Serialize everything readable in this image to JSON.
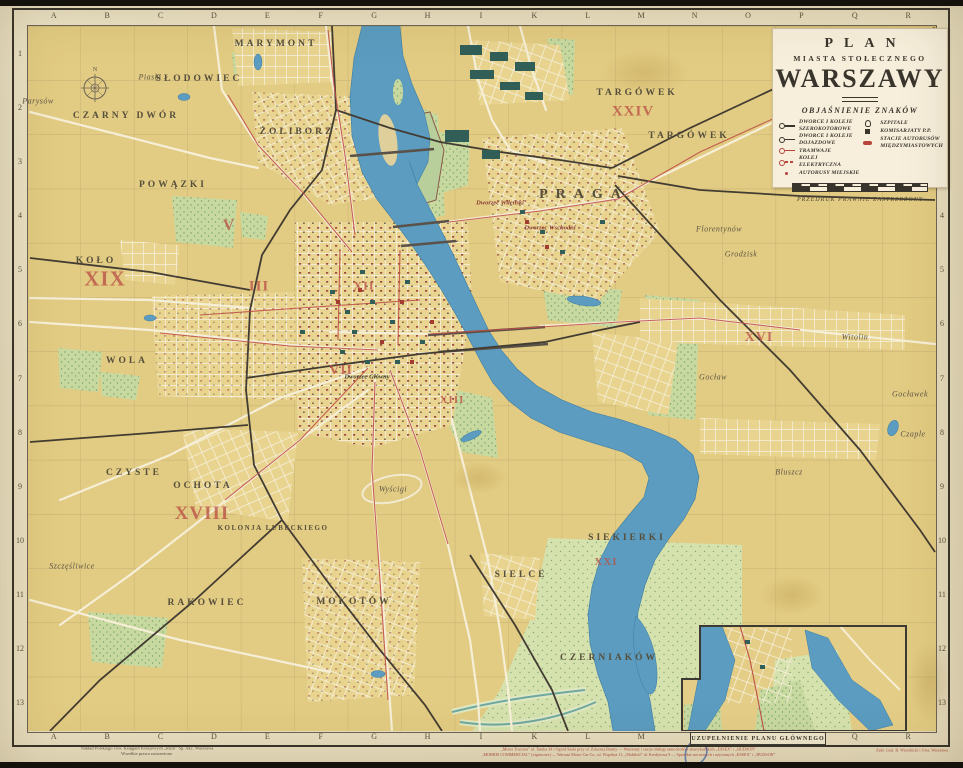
{
  "colors": {
    "paper": "#ece3c6",
    "land": "#e2cb82",
    "water": "#5b9cc0",
    "park": "#c8d9a0",
    "road": "#f6efd7",
    "rail": "#433c32",
    "tram": "#bf5048",
    "accent_red": "#bb5147",
    "frame": "#37322a",
    "cartouche_bg": "#f7efdc"
  },
  "cartouche": {
    "title1": "PLAN",
    "title2": "MIASTA STOŁECZNEGO",
    "title3": "WARSZAWY",
    "legend_title": "OBJAŚNIENIE ZNAKÓW",
    "legend_left": [
      {
        "sym": "rail-broad",
        "label": "DWORCE I KOLEJE SZEROKOTOROWE"
      },
      {
        "sym": "rail-local",
        "label": "DWORCE I KOLEJE DOJAZDOWE"
      },
      {
        "sym": "tram",
        "label": "TRAMWAJE"
      },
      {
        "sym": "elec",
        "label": "KOLEJ ELEKTRYCZNA"
      },
      {
        "sym": "bus",
        "label": "AUTOBUSY MIEJSKIE"
      }
    ],
    "legend_right": [
      {
        "sym": "hospital",
        "label": "SZPITALE"
      },
      {
        "sym": "police",
        "label": "KOMISARJATY P.P."
      },
      {
        "sym": "busstation",
        "label": "STACJE AUTOBUSÓW MIĘDZYMIASTOWYCH"
      }
    ],
    "scale_note": "PRZEDRUK PRAWNIE ZASTRZEŻONY"
  },
  "grid": {
    "cols": [
      "A",
      "B",
      "C",
      "D",
      "E",
      "F",
      "G",
      "H",
      "I",
      "K",
      "L",
      "M",
      "N",
      "O",
      "P",
      "Q",
      "R"
    ],
    "rows": [
      "1",
      "2",
      "3",
      "4",
      "5",
      "6",
      "7",
      "8",
      "9",
      "10",
      "11",
      "12",
      "13"
    ]
  },
  "map": {
    "compass": "N",
    "inset_caption": "UZUPEŁNIENIE PLANU GŁÓWNEGO",
    "labels": [
      {
        "text": "MARYMONT",
        "cls": "lbl district",
        "style": "left:276px;top:44px"
      },
      {
        "text": "Piaski",
        "cls": "lbl hamlet",
        "style": "left:150px;top:77px"
      },
      {
        "text": "Parysów",
        "cls": "lbl hamlet",
        "style": "left:38px;top:101px"
      },
      {
        "text": "SŁODOWIEC",
        "cls": "lbl district",
        "style": "left:199px;top:79px"
      },
      {
        "text": "CZARNY DWÓR",
        "cls": "lbl district",
        "style": "left:126px;top:116px"
      },
      {
        "text": "ŻOLIBORZ",
        "cls": "lbl district",
        "style": "left:297px;top:132px"
      },
      {
        "text": "POWĄZKI",
        "cls": "lbl district",
        "style": "left:173px;top:185px"
      },
      {
        "text": "KOŁO",
        "cls": "lbl district",
        "style": "left:96px;top:261px"
      },
      {
        "text": "WOLA",
        "cls": "lbl district",
        "style": "left:127px;top:361px"
      },
      {
        "text": "CZYSTE",
        "cls": "lbl district",
        "style": "left:134px;top:473px"
      },
      {
        "text": "OCHOTA",
        "cls": "lbl district",
        "style": "left:203px;top:486px"
      },
      {
        "text": "KOLONJA LUBECKIEGO",
        "cls": "lbl district district-sm",
        "style": "left:273px;top:528px"
      },
      {
        "text": "Szczęśliwice",
        "cls": "lbl hamlet",
        "style": "left:72px;top:566px"
      },
      {
        "text": "RAKOWIEC",
        "cls": "lbl district",
        "style": "left:207px;top:603px"
      },
      {
        "text": "MOKOTÓW",
        "cls": "lbl district",
        "style": "left:354px;top:602px"
      },
      {
        "text": "SIELCE",
        "cls": "lbl district",
        "style": "left:521px;top:575px"
      },
      {
        "text": "SIEKIERKI",
        "cls": "lbl district",
        "style": "left:627px;top:538px"
      },
      {
        "text": "CZERNIAKÓW",
        "cls": "lbl district",
        "style": "left:609px;top:658px"
      },
      {
        "text": "PRAGA",
        "cls": "lbl district district-lg",
        "style": "left:584px;top:195px"
      },
      {
        "text": "TARGÓWEK",
        "cls": "lbl district",
        "style": "left:637px;top:93px"
      },
      {
        "text": "TARGÓWEK",
        "cls": "lbl district",
        "style": "left:689px;top:136px"
      },
      {
        "text": "Florentynów",
        "cls": "lbl hamlet",
        "style": "left:719px;top:229px"
      },
      {
        "text": "Grodzisk",
        "cls": "lbl hamlet",
        "style": "left:741px;top:254px"
      },
      {
        "text": "Witolin",
        "cls": "lbl hamlet",
        "style": "left:855px;top:337px"
      },
      {
        "text": "Gocław",
        "cls": "lbl hamlet",
        "style": "left:713px;top:377px"
      },
      {
        "text": "Gocławek",
        "cls": "lbl hamlet",
        "style": "left:910px;top:394px"
      },
      {
        "text": "Czaple",
        "cls": "lbl hamlet",
        "style": "left:913px;top:434px"
      },
      {
        "text": "Bluszcz",
        "cls": "lbl hamlet",
        "style": "left:789px;top:472px"
      },
      {
        "text": "Wyścigi",
        "cls": "lbl hamlet",
        "style": "left:393px;top:489px"
      },
      {
        "text": "Dworzec Główny",
        "cls": "lbl station-dk",
        "style": "left:367px;top:377px"
      },
      {
        "text": "Dworzec Wileński",
        "cls": "lbl station",
        "style": "left:500px;top:203px"
      },
      {
        "text": "Dworzec Wschodni",
        "cls": "lbl station",
        "style": "left:550px;top:228px"
      }
    ],
    "numerals": [
      {
        "text": "XIX",
        "style": "left:105px;top:279px;font-size:21px"
      },
      {
        "text": "XVIII",
        "style": "left:202px;top:514px;font-size:19px"
      },
      {
        "text": "XXIV",
        "style": "left:633px;top:112px;font-size:15px"
      },
      {
        "text": "XXI",
        "style": "left:606px;top:562px;font-size:11px"
      },
      {
        "text": "V",
        "style": "left:229px;top:226px;font-size:16px"
      },
      {
        "text": "III",
        "style": "left:259px;top:287px;font-size:15px"
      },
      {
        "text": "VII",
        "style": "left:341px;top:371px;font-size:14px"
      },
      {
        "text": "XII",
        "style": "left:364px;top:286px;font-size:12px"
      },
      {
        "text": "XIII",
        "style": "left:452px;top:400px;font-size:11px"
      },
      {
        "text": "XVI",
        "style": "left:759px;top:338px;font-size:14px"
      }
    ]
  },
  "imprint": {
    "left1": "Nakład Polskiego Tow. Księgarń Kolejowych „Ruch” Sp. Akc. Warszawa",
    "left2": "Wszelkie prawa zastrzeżone.",
    "right1": "„Motor Traction” ul. Tamka 34 i Ogród Saski przy ul. Żelaznej Bramy — Warsztaty i stacja obsługi samochodów amerykańskich „ESSEX” i „HUDSON”",
    "right2": "„MORRIS COMMERCIAL” (ciężarowe) — Warrant Motor Car Co., ul. Wspólna 11, „Mobiloil” ul. Kredytowa 9 — Sprzedaż aut nowych i używanych „ESSEX” i „HUDSON”",
    "far_right": "Zakł. Graf. B. Wierzbicki i S-ka, Warszawa"
  }
}
